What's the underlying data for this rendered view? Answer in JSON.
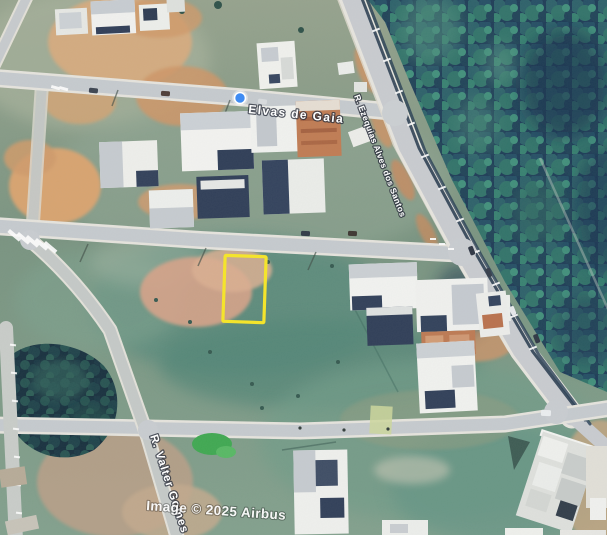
{
  "map": {
    "type": "satellite-imagery",
    "attribution": "Image © 2025 Airbus"
  },
  "streets": {
    "elvas": "Elvas de Gaia",
    "diagonal": "R. Ezequias Alves dos Santos",
    "valter": "R. Valter Gomes"
  },
  "marker": {
    "color": "#3f8cf3"
  },
  "highlight": {
    "color": "#f4e42c"
  }
}
